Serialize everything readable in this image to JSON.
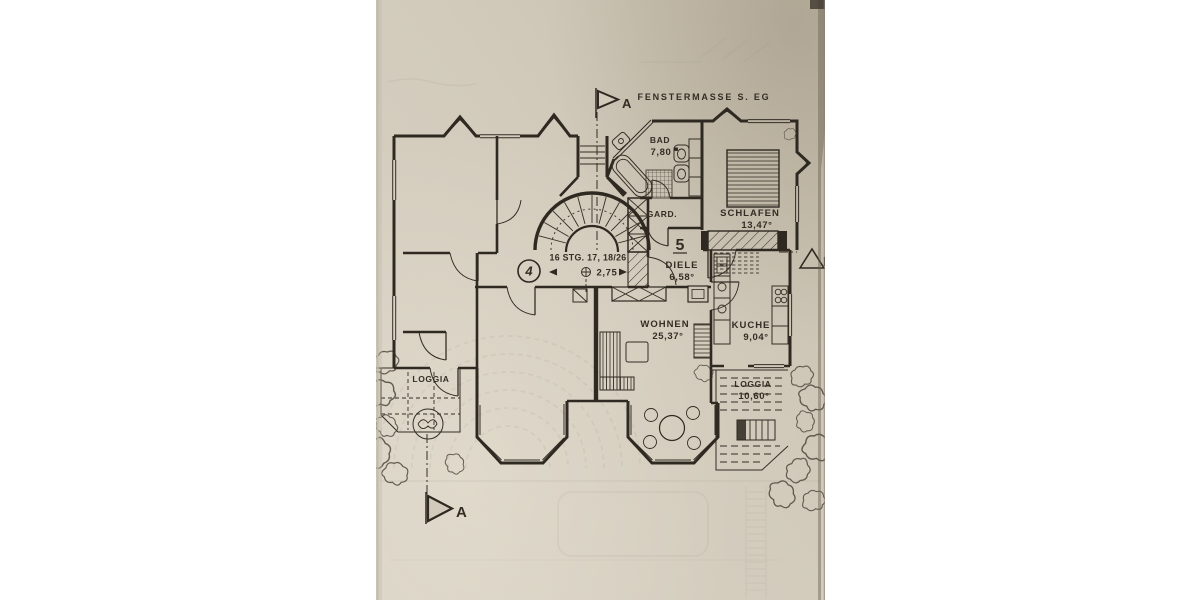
{
  "document": {
    "type_note": "FENSTERMASSE S. EG"
  },
  "markers": {
    "section_top": "A",
    "section_bottom": "A",
    "section_right": "B"
  },
  "stairwell": {
    "steps_note": "16 STG. 17, 18/26",
    "level": "2,75"
  },
  "units": {
    "unit_left": "4",
    "unit_right": "5"
  },
  "rooms": {
    "bad": {
      "name": "BAD",
      "area": "7,80"
    },
    "gard": {
      "name": "GARD."
    },
    "schlafen": {
      "name": "SCHLAFEN",
      "area": "13,47°"
    },
    "diele": {
      "name": "DIELE",
      "area": "6,58°"
    },
    "wohnen": {
      "name": "WOHNEN",
      "area": "25,37°"
    },
    "kuche": {
      "name": "KUCHE",
      "area": "9,04°"
    },
    "loggia_left": {
      "name": "LOGGIA"
    },
    "loggia_right": {
      "name": "LOGGIA",
      "area": "10,60°"
    }
  },
  "colors": {
    "background": "#ffffff",
    "paper": "#d2cbbc",
    "ink": "#2e2921",
    "ghost": "#8f897a"
  }
}
